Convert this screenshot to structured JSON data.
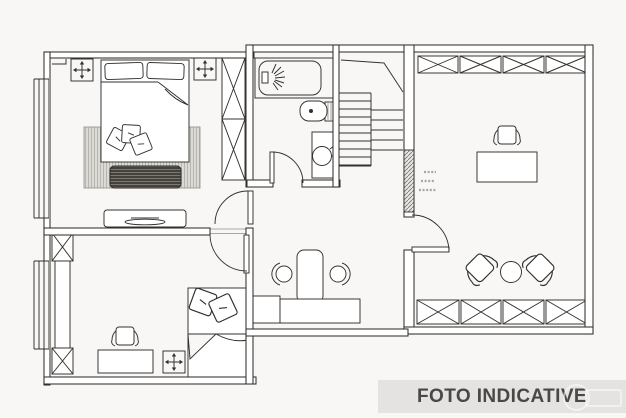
{
  "banner": {
    "label": "FOTO INDICATIVE"
  },
  "colors": {
    "paper": "#f8f7f5",
    "line": "#33312e",
    "wall_fill": "#ffffff",
    "rug_fill": "#dcdad5",
    "rug_hatch": "#aeaca6",
    "bench_fill": "#45423e",
    "bench_hatch": "#94918b",
    "banner_bg": "#e5e3e1",
    "banner_fg": "#4a4846",
    "annotation": "#8d8b88"
  },
  "symbols": [
    "ceiling-light-symbol",
    "wardrobe-x-box",
    "double-bed",
    "decorative-pillow",
    "rug",
    "storage-bench",
    "dresser-tv",
    "bathtub-shower",
    "toilet",
    "sink-vanity",
    "door-swing",
    "staircase",
    "desk",
    "office-chair",
    "armchair",
    "stool",
    "round-table",
    "single-bed",
    "window"
  ]
}
